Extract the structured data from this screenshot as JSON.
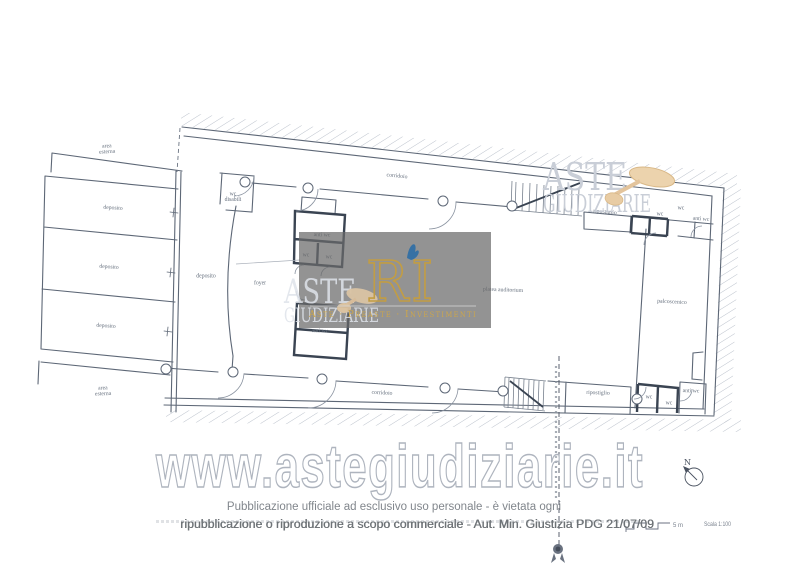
{
  "watermarks": {
    "aste_line1": "ASTE",
    "aste_line2": "GIUDIZIARIE",
    "site": "www.astegiudiziarie.it",
    "banner_logo": "RI",
    "banner_tagline": "Aste · Preaste · Investimenti"
  },
  "footer": {
    "line1": "Pubblicazione ufficiale ad esclusivo uso personale - è vietata ogni",
    "line2": "ripubblicazione o riproduzione a scopo commerciale - Aut. Min. Giustizia PDG 21/07/09"
  },
  "plan": {
    "scale_label": "Scala 1:100",
    "scale_bar_unit": "5 m",
    "north_label": "N",
    "room_labels": [
      {
        "lines": [
          "area",
          "esterna"
        ],
        "x": 107,
        "y": 149,
        "r": -3
      },
      {
        "lines": [
          "deposito"
        ],
        "x": 113,
        "y": 208,
        "r": 4
      },
      {
        "lines": [
          "deposito"
        ],
        "x": 109,
        "y": 267,
        "r": 4
      },
      {
        "lines": [
          "deposito"
        ],
        "x": 106,
        "y": 326,
        "r": 4
      },
      {
        "lines": [
          "deposito"
        ],
        "x": 206,
        "y": 276,
        "r": 0
      },
      {
        "lines": [
          "area",
          "esterna"
        ],
        "x": 103,
        "y": 391,
        "r": -2
      },
      {
        "lines": [
          "wc",
          "disabili"
        ],
        "x": 233,
        "y": 197,
        "r": 0
      },
      {
        "lines": [
          "foyer"
        ],
        "x": 260,
        "y": 283,
        "r": 0
      },
      {
        "lines": [
          "anti wc"
        ],
        "x": 322,
        "y": 235,
        "r": 2
      },
      {
        "lines": [
          "wc"
        ],
        "x": 306,
        "y": 255,
        "r": 0
      },
      {
        "lines": [
          "wc"
        ],
        "x": 329,
        "y": 257,
        "r": 0
      },
      {
        "lines": [
          "anti wc"
        ],
        "x": 320,
        "y": 331,
        "r": 2
      },
      {
        "lines": [
          "corridoio"
        ],
        "x": 397,
        "y": 176,
        "r": 6
      },
      {
        "lines": [
          "corridoio"
        ],
        "x": 382,
        "y": 393,
        "r": 3
      },
      {
        "lines": [
          "platea auditorium"
        ],
        "x": 503,
        "y": 290,
        "r": 2
      },
      {
        "lines": [
          "palcoscenico"
        ],
        "x": 672,
        "y": 302,
        "r": 3
      },
      {
        "lines": [
          "ripostiglio"
        ],
        "x": 605,
        "y": 212,
        "r": 5
      },
      {
        "lines": [
          "wc"
        ],
        "x": 660,
        "y": 214,
        "r": 0
      },
      {
        "lines": [
          "wc"
        ],
        "x": 681,
        "y": 208,
        "r": 0
      },
      {
        "lines": [
          "anti wc"
        ],
        "x": 701,
        "y": 219,
        "r": 5
      },
      {
        "lines": [
          "ripostiglio"
        ],
        "x": 598,
        "y": 393,
        "r": 2
      },
      {
        "lines": [
          "wc"
        ],
        "x": 649,
        "y": 397,
        "r": 0
      },
      {
        "lines": [
          "wc"
        ],
        "x": 669,
        "y": 403,
        "r": 0
      },
      {
        "lines": [
          "anti wc"
        ],
        "x": 691,
        "y": 391,
        "r": 2
      }
    ]
  },
  "colors": {
    "line": "#5d6776",
    "dark_wall": "#3a4452",
    "hatch": "#bcc2cc",
    "label": "#66707e",
    "watermark_gray": "#c9ced7",
    "banner_bg": "rgba(106,106,106,0.72)",
    "gold": "#c29d44",
    "tan": "#e9cfa8",
    "blue_flame": "#2e6ea6",
    "footer_text": "#81868c"
  }
}
